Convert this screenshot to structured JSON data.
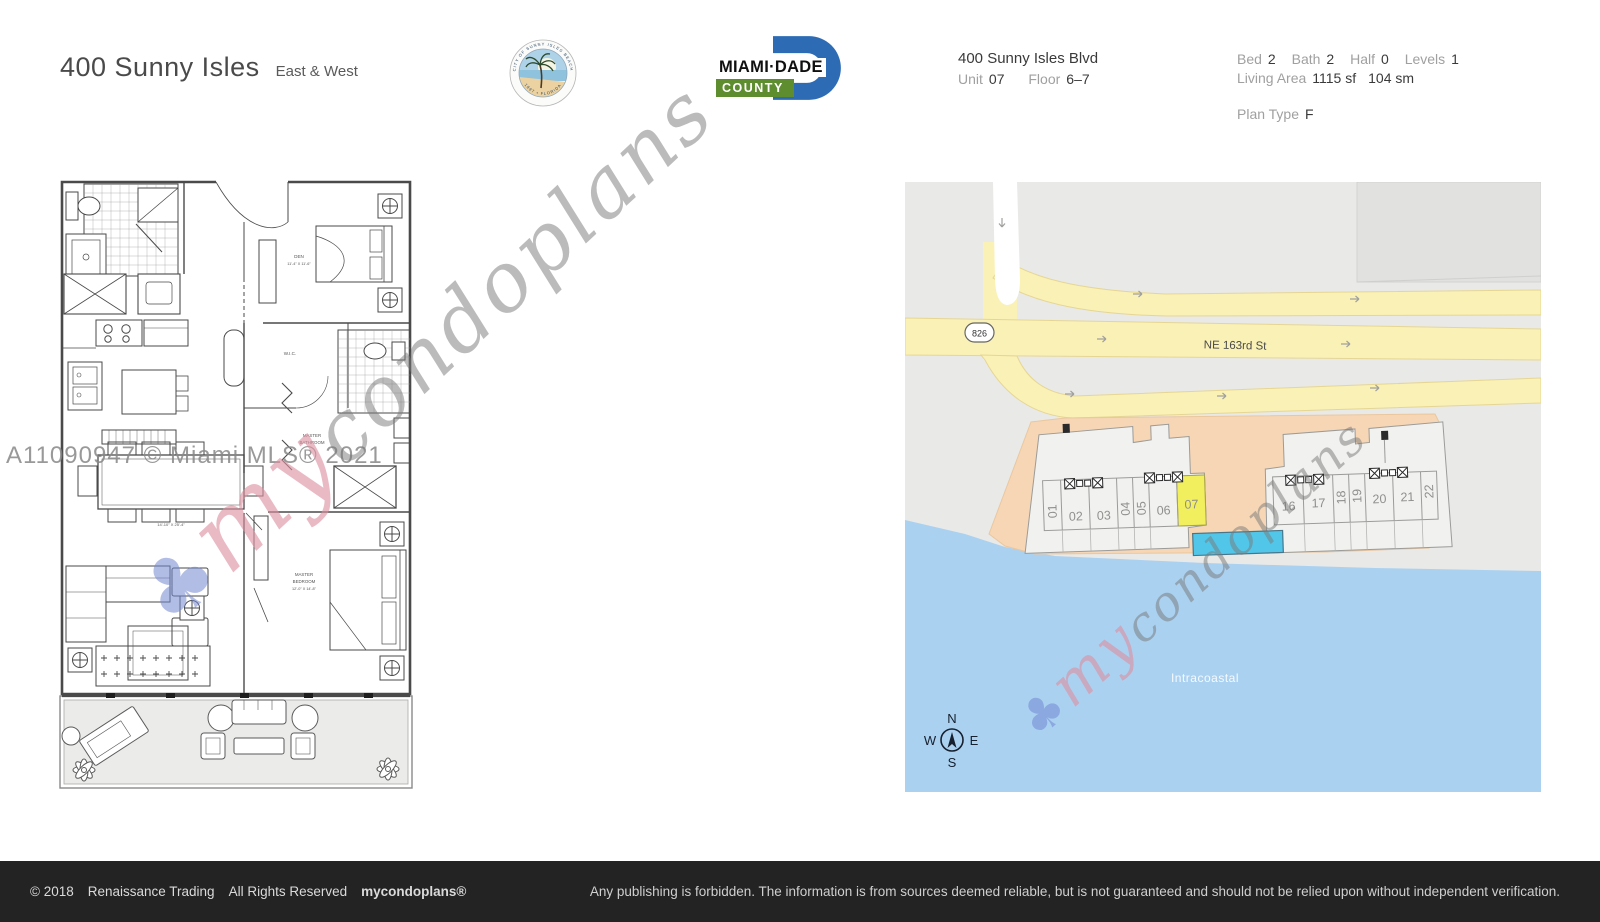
{
  "header": {
    "title": "400 Sunny Isles",
    "subtitle": "East & West",
    "seal": {
      "ring_top": "CITY OF SUNNY ISLES BEACH",
      "ring_bottom": "1997 • FLORIDA"
    },
    "county_logo": {
      "line1": "MIAMI·DADE",
      "line2": "COUNTY"
    },
    "address": {
      "line1": "400 Sunny Isles Blvd",
      "unit_label": "Unit",
      "unit": "07",
      "floor_label": "Floor",
      "floor": "6–7"
    },
    "stats": {
      "bed_label": "Bed",
      "bed": "2",
      "bath_label": "Bath",
      "bath": "2",
      "half_label": "Half",
      "half": "0",
      "levels_label": "Levels",
      "levels": "1",
      "living_label": "Living Area",
      "living_sf": "1115 sf",
      "living_sm": "104 sm",
      "plan_label": "Plan Type",
      "plan": "F"
    }
  },
  "floorplan": {
    "labels": {
      "den": "DEN",
      "den_dim": "11'-4\" X 11'-6\"",
      "wic": "W.I.C.",
      "mbath1": "MASTER",
      "mbath2": "BATHROOM",
      "mbed1": "MASTER",
      "mbed2": "BEDROOM",
      "mbed_dim": "12'-0\" X 14'-8\"",
      "living_dim": "14'-10\" X 25'-4\""
    }
  },
  "map": {
    "route_badge": "826",
    "street": "NE 163rd St",
    "water_label": "Intracoastal",
    "compass": {
      "n": "N",
      "e": "E",
      "s": "S",
      "w": "W"
    },
    "units_west": [
      "01",
      "02",
      "03",
      "04",
      "05",
      "06",
      "07"
    ],
    "units_east": [
      "16",
      "17",
      "18",
      "19",
      "20",
      "21",
      "22"
    ],
    "highlighted_unit": "07",
    "colors": {
      "map_bg": "#e9e9e7",
      "road": "#faf1b6",
      "building_lot": "#f6d6b5",
      "unit_fill": "#f1f1ef",
      "unit_highlight": "#f2ef5f",
      "pool": "#52c6e8",
      "water": "#abd1f1"
    }
  },
  "watermarks": {
    "mls": "A11090947 © Miami MLS® 2021",
    "trefoil_icon": "♣",
    "brand_prefix": "my",
    "brand_suffix": "condoplans"
  },
  "footer": {
    "copyright": "© 2018",
    "company": "Renaissance Trading",
    "rights": "All Rights Reserved",
    "brand": "mycondoplans®",
    "disclaimer": "Any publishing is forbidden.  The information is from sources deemed reliable, but is not guaranteed and should not be relied upon without independent verification."
  }
}
